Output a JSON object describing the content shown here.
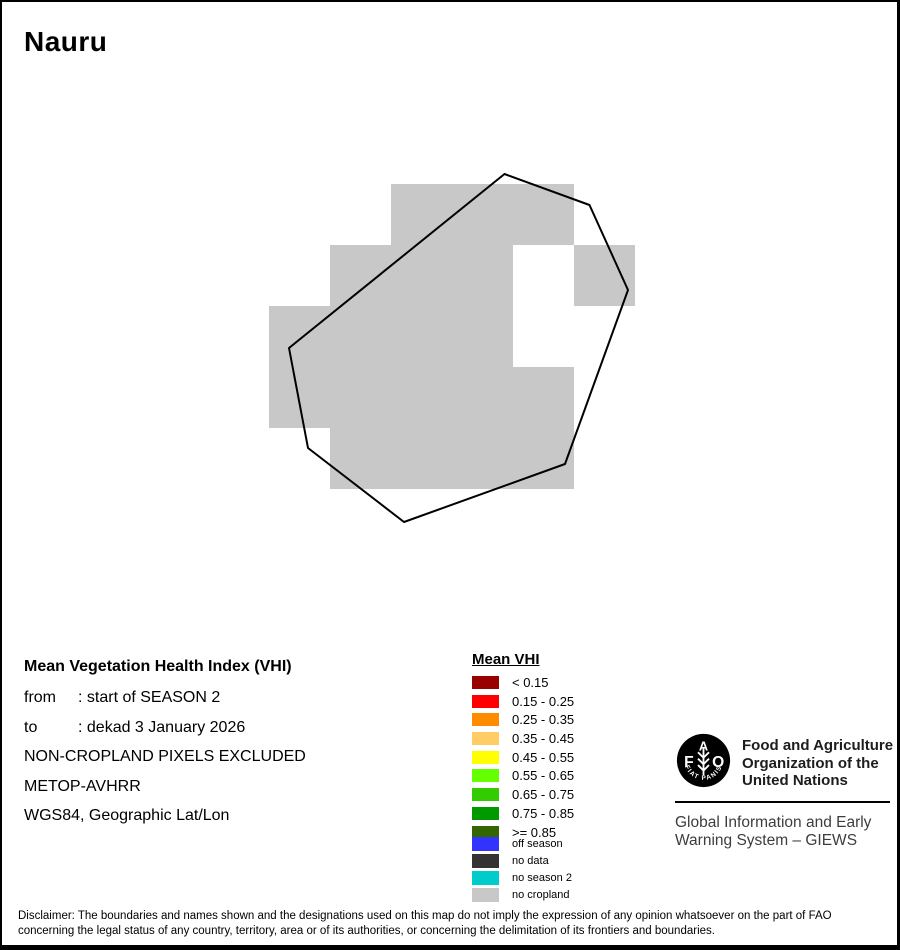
{
  "title": "Nauru",
  "info": {
    "heading": "Mean Vegetation Health Index (VHI)",
    "from_label": "from",
    "from_value": ": start of SEASON 2",
    "to_label": "to",
    "to_value": ": dekad 3 January 2026",
    "line3": "NON-CROPLAND PIXELS EXCLUDED",
    "line4": "METOP-AVHRR",
    "line5": "WGS84, Geographic Lat/Lon"
  },
  "legend": {
    "title": "Mean VHI",
    "classes": [
      {
        "label": "< 0.15",
        "color": "#990000"
      },
      {
        "label": "0.15 - 0.25",
        "color": "#FF0000"
      },
      {
        "label": "0.25 - 0.35",
        "color": "#FF8C00"
      },
      {
        "label": "0.35 - 0.45",
        "color": "#FFCC66"
      },
      {
        "label": "0.45 - 0.55",
        "color": "#FFFF00"
      },
      {
        "label": "0.55 - 0.65",
        "color": "#66FF00"
      },
      {
        "label": "0.65 - 0.75",
        "color": "#33CC00"
      },
      {
        "label": "0.75 - 0.85",
        "color": "#009900"
      },
      {
        "label": ">= 0.85",
        "color": "#336600"
      }
    ],
    "extra": [
      {
        "label": "off season",
        "color": "#3333FF"
      },
      {
        "label": "no data",
        "color": "#333333"
      },
      {
        "label": "no season 2",
        "color": "#00CCCC"
      },
      {
        "label": "no cropland",
        "color": "#C8C8C8"
      }
    ]
  },
  "map": {
    "no_cropland_color": "#C8C8C8",
    "outline_color": "#000000",
    "grid": {
      "x0": 267,
      "y0": 182,
      "cell": 61
    },
    "cells": [
      [
        2,
        0
      ],
      [
        3,
        0
      ],
      [
        4,
        0
      ],
      [
        1,
        1
      ],
      [
        2,
        1
      ],
      [
        3,
        1
      ],
      [
        5,
        1
      ],
      [
        0,
        2
      ],
      [
        1,
        2
      ],
      [
        2,
        2
      ],
      [
        3,
        2
      ],
      [
        0,
        3
      ],
      [
        1,
        3
      ],
      [
        2,
        3
      ],
      [
        3,
        3
      ],
      [
        4,
        3
      ],
      [
        1,
        4
      ],
      [
        2,
        4
      ],
      [
        3,
        4
      ],
      [
        4,
        4
      ]
    ],
    "outline": [
      [
        502.5,
        172
      ],
      [
        587.5,
        203
      ],
      [
        626,
        288
      ],
      [
        563,
        462
      ],
      [
        402,
        520
      ],
      [
        306,
        446
      ],
      [
        287,
        346
      ]
    ]
  },
  "fao": {
    "logo_letters": {
      "f": "F",
      "a": "A",
      "o": "O"
    },
    "logo_motto": "FIAT PANIS",
    "org_lines": [
      "Food and Agriculture",
      "Organization of the",
      "United Nations"
    ],
    "giews_lines": [
      "Global Information and Early",
      "Warning System – GIEWS"
    ]
  },
  "disclaimer": {
    "line1": "Disclaimer: The boundaries and names shown and the designations used on this map do not imply the expression of any opinion whatsoever on the part of FAO",
    "line2": "concerning the legal status of any country, territory, area or of its authorities, or concerning the delimitation of its frontiers and boundaries."
  }
}
